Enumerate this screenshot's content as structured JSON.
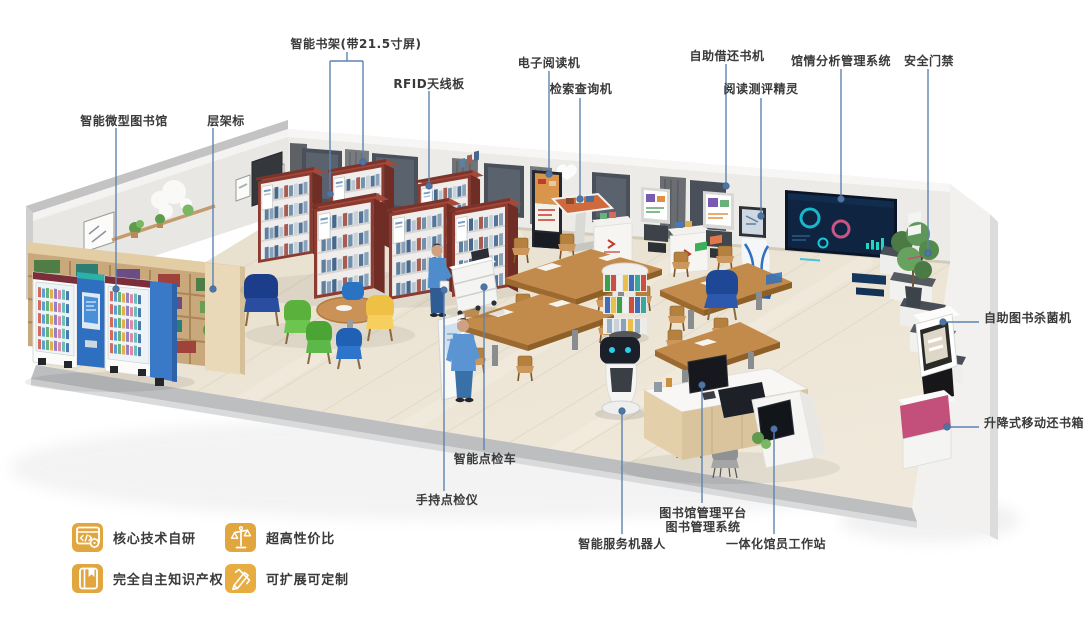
{
  "callouts": {
    "smart_bookshelf": "智能书架(带21.5寸屏)",
    "rfid_antenna": "RFID天线板",
    "micro_library": "智能微型图书馆",
    "shelf_label": "层架标",
    "e_reader": "电子阅读机",
    "search_kiosk": "检索查询机",
    "self_checkout": "自助借还书机",
    "reading_eval": "阅读测评精灵",
    "analytics_system": "馆情分析管理系统",
    "security_gate": "安全门禁",
    "book_sterilizer": "自助图书杀菌机",
    "mobile_return_box": "升降式移动还书箱",
    "inspection_cart": "智能点检车",
    "handheld_scanner": "手持点检仪",
    "service_robot": "智能服务机器人",
    "platform_line1": "图书馆管理平台",
    "platform_line2": "图书管理系统",
    "staff_workstation": "一体化馆员工作站"
  },
  "features": [
    {
      "label": "核心技术自研",
      "icon": "code-window-gear-icon"
    },
    {
      "label": "超高性价比",
      "icon": "balance-scale-icon"
    },
    {
      "label": "完全自主知识产权",
      "icon": "book-copyright-icon"
    },
    {
      "label": "可扩展可定制",
      "icon": "crossed-pencils-icon"
    }
  ],
  "colors": {
    "callout_line": "#5d83b0",
    "callout_dot": "#4e75a4",
    "label_text": "#3a3a3a",
    "badge_gold": "#e2a63e",
    "shelf_wood_red": "#8c3b30",
    "floor": "#e9e1d0"
  }
}
